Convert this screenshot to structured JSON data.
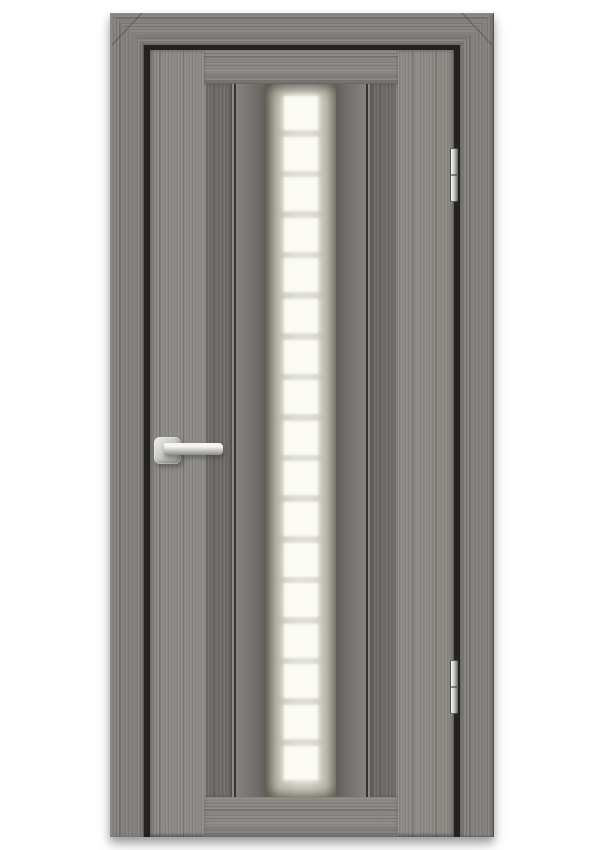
{
  "meta": {
    "subject": "interior door with frame, gray woodgrain finish, vertical frosted glass insert",
    "view": "front product photo on white background"
  },
  "colors": {
    "bg": "#ffffff",
    "wood_casing": "#84817e",
    "wood_door": "#8e8b87",
    "wood_rail": "#8a8683",
    "wood_mullion": "#6f6c68",
    "wood_strip": "#888481",
    "reveal_gap": "#23221e",
    "glass_frost": "#d7d5c9",
    "glass_pane": "#fbfaf5",
    "metal": "#c6c6c4"
  },
  "glass": {
    "pane_count": 17,
    "pane_shape": "square",
    "columns": 1
  },
  "hardware": {
    "hinge_count": 2,
    "hinge_side": "right",
    "handle_side": "left"
  }
}
